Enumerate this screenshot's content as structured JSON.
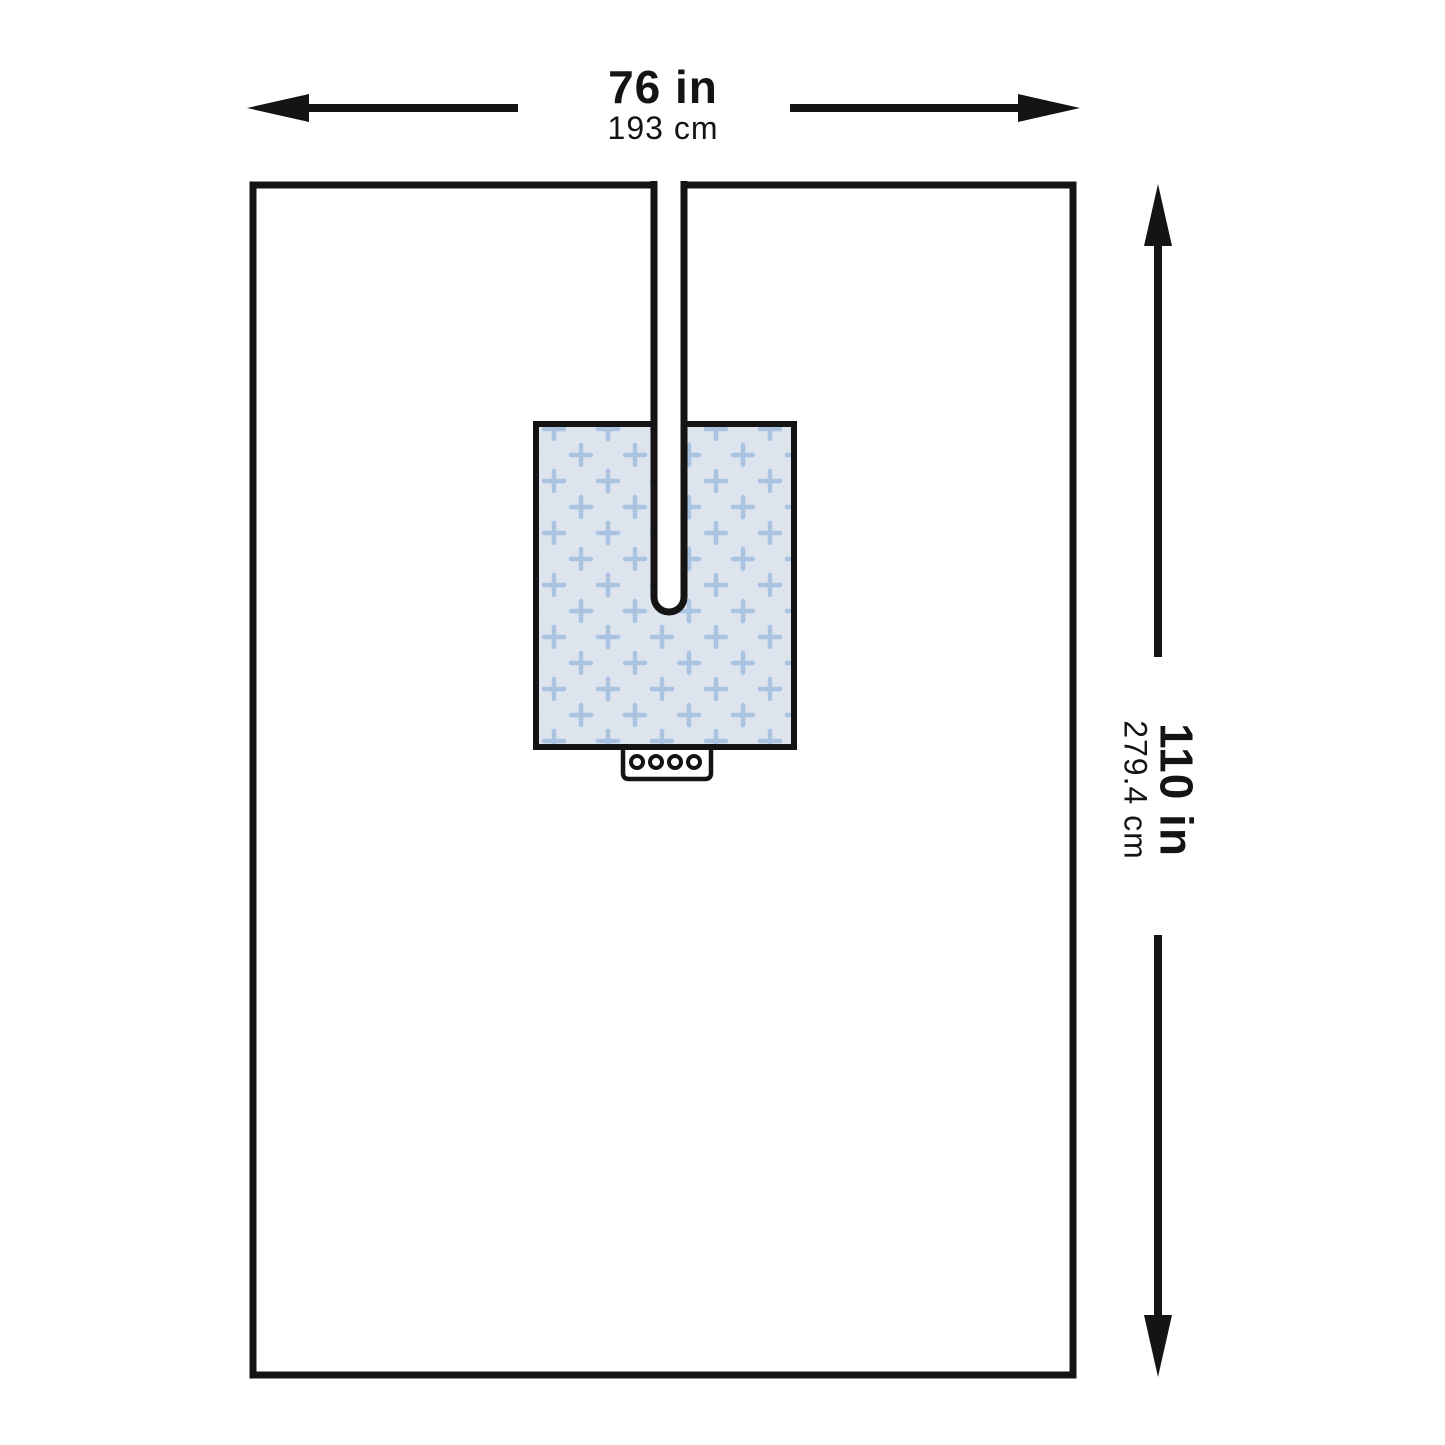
{
  "diagram": {
    "width_label": {
      "inches": "76 in",
      "cm": "193 cm"
    },
    "height_label": {
      "inches": "110 in",
      "cm": "279.4 cm"
    },
    "colors": {
      "line": "#141414",
      "drape_fill": "#ffffff",
      "patch_fill": "#dde4ee",
      "patch_cross": "#a9c3e0",
      "background": "#ffffff"
    }
  }
}
